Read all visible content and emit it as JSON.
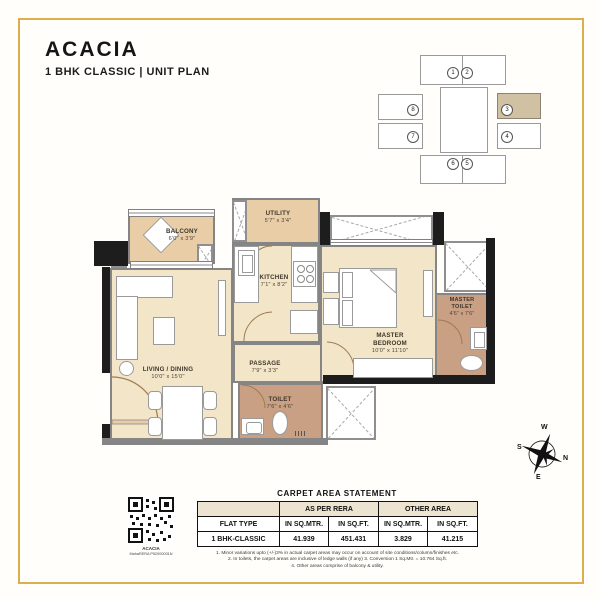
{
  "header": {
    "title": "ACACIA",
    "subtitle": "1 BHK CLASSIC | UNIT PLAN"
  },
  "key_plan": {
    "units": [
      "1",
      "2",
      "8",
      "3",
      "7",
      "4",
      "6",
      "5"
    ],
    "highlighted_unit": "3",
    "highlight_color": "#cfc1a2"
  },
  "rooms": {
    "balcony": {
      "name": "BALCONY",
      "dims": "6'0\" x 3'9\""
    },
    "living": {
      "name": "LIVING / DINING",
      "dims": "10'0\" x 15'0\""
    },
    "utility": {
      "name": "UTILITY",
      "dims": "5'7\" x 3'4\""
    },
    "kitchen": {
      "name": "KITCHEN",
      "dims": "7'1\" x 8'2\""
    },
    "master_bedroom": {
      "name": "MASTER BEDROOM",
      "dims": "10'0\" x 11'10\""
    },
    "master_toilet": {
      "name": "MASTER TOILET",
      "dims": "4'6\" x 7'6\""
    },
    "passage": {
      "name": "PASSAGE",
      "dims": "7'9\" x 3'3\""
    },
    "toilet": {
      "name": "TOILET",
      "dims": "7'6\" x 4'6\""
    }
  },
  "compass": {
    "n": "N",
    "s": "S",
    "e": "E",
    "w": "W"
  },
  "carpet_table": {
    "title": "CARPET AREA STATEMENT",
    "group_headers": [
      "AS PER RERA",
      "OTHER AREA"
    ],
    "col_headers": [
      "FLAT TYPE",
      "IN SQ.MTR.",
      "IN SQ.FT.",
      "IN SQ.MTR.",
      "IN SQ.FT."
    ],
    "row": {
      "flat_type": "1 BHK-CLASSIC",
      "rera_sqmtr": "41.939",
      "rera_sqft": "451.431",
      "other_sqmtr": "3.829",
      "other_sqft": "41.215"
    }
  },
  "footnotes": {
    "line1": "1. Minor variations upto (+/-)3% in actual carpet areas may occur on account of site conditions/column/finishes etc.",
    "line2": "2. In toilets, the carpet areas are inclusive of ledge walls (if any) 3. Conversion 1 Sq.Mtr. = 10.764 Sq.ft.",
    "line3": "4. Other areas comprise of balcony & utility."
  },
  "qr": {
    "caption_line1": "ACACIA",
    "caption_line2": "MahaRERA P52000031N"
  },
  "colors": {
    "accent_gold": "#dcae4e",
    "floor_beige": "#f3e5c8",
    "floor_tan": "#e8cda6",
    "toilet_floor": "#c9a083",
    "wall_black": "#1d1d1d",
    "wall_gray": "#858585",
    "table_header_bg": "#ece4d0"
  }
}
